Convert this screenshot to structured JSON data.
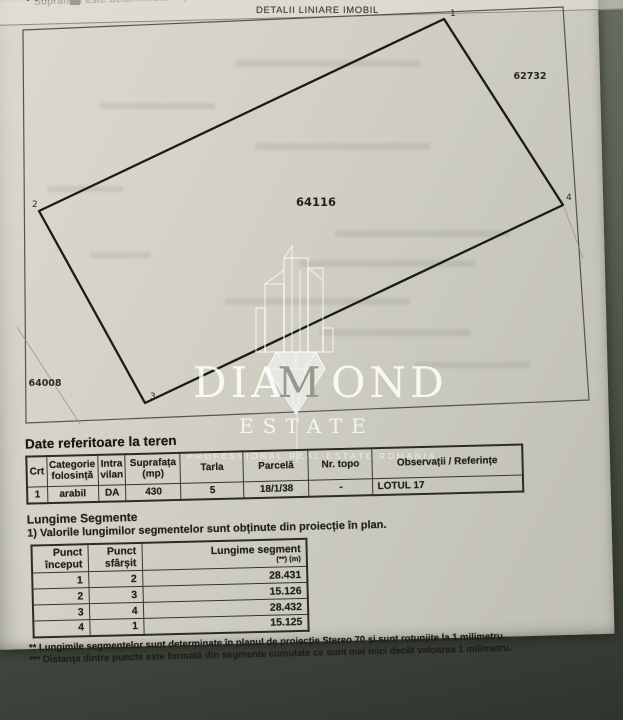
{
  "page": {
    "top_note": "* Suprafața este determinată în pla",
    "header_title": "DETALII LINIARE IMOBIL"
  },
  "plot": {
    "parcel_number": "64116",
    "neighbor_right": "62732",
    "neighbor_left": "64008",
    "vertex_labels": [
      "1",
      "2",
      "3",
      "4"
    ]
  },
  "watermark": {
    "word_start": "DIA",
    "word_m": "M",
    "word_end": "OND",
    "estate": "ESTATE",
    "tagline": "PROFESSIONAL REAL ESTATE ROMANIA"
  },
  "land": {
    "title": "Date referitoare la teren",
    "headers": [
      {
        "l1": "Crt",
        "l2": ""
      },
      {
        "l1": "Categorie",
        "l2": "folosință"
      },
      {
        "l1": "Intra",
        "l2": "vilan"
      },
      {
        "l1": "Suprafața",
        "l2": "(mp)"
      },
      {
        "l1": "Tarla",
        "l2": ""
      },
      {
        "l1": "Parcelă",
        "l2": ""
      },
      {
        "l1": "Nr. topo",
        "l2": ""
      },
      {
        "l1": "Observații / Referințe",
        "l2": ""
      }
    ],
    "row": {
      "crt": "1",
      "categorie": "arabil",
      "intravilan": "DA",
      "suprafata": "430",
      "tarla": "5",
      "parcela": "18/1/38",
      "nr_topo": "-",
      "observatii": "LOTUL 17"
    }
  },
  "segments": {
    "title": "Lungime Segmente",
    "note": "1) Valorile lungimilor segmentelor sunt obținute din proiecție în plan.",
    "headers": [
      {
        "l1": "Punct",
        "l2": "început"
      },
      {
        "l1": "Punct",
        "l2": "sfârșit"
      },
      {
        "l1": "Lungime segment",
        "l2": "(**) (m)"
      }
    ],
    "rows": [
      {
        "from": "1",
        "to": "2",
        "length": "28.431"
      },
      {
        "from": "2",
        "to": "3",
        "length": "15.126"
      },
      {
        "from": "3",
        "to": "4",
        "length": "28.432"
      },
      {
        "from": "4",
        "to": "1",
        "length": "15.125"
      }
    ]
  },
  "footnotes": [
    "** Lungimile segmentelor sunt determinate în planul de proiecție Stereo 70 și sunt rotunjite la 1 milimetru.",
    "*** Distanța dintre puncte este formată din segmente cumulate ce sunt mai mici decât valoarea 1 milimetru."
  ],
  "colors": {
    "paper": "#d2d0c5",
    "ink": "#26261f",
    "watermark": "#ffffff",
    "background_dark": "#3c423b"
  }
}
